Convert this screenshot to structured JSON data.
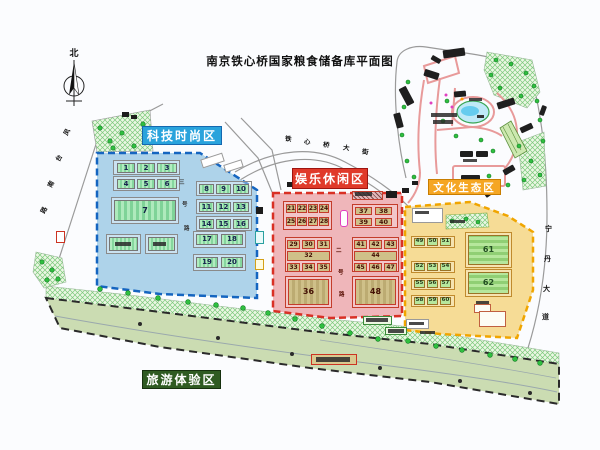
{
  "title": "南京铁心桥国家粮食储备库平面图",
  "compass_north": "北",
  "zones": {
    "tech": {
      "label": "科技时尚区",
      "label_bg": "#29a3dc",
      "label_border": "#1468b0",
      "fill": "#aed3ea",
      "border": "#1565c0"
    },
    "leisure": {
      "label": "娱乐休闲区",
      "label_bg": "#e03a2a",
      "label_border": "#9e1410",
      "fill": "#efb6ba",
      "border": "#d93025"
    },
    "culture": {
      "label": "文化生态区",
      "label_bg": "#f5a623",
      "label_border": "#c87d00",
      "fill": "#f6dc96",
      "border": "#f0a500"
    },
    "tourism": {
      "label": "旅游体验区",
      "label_bg": "#2f5b22",
      "label_border": "#16300e",
      "fill": "#cbdcb2",
      "border": "#2a2a2a"
    }
  },
  "road_labels": {
    "top_street": {
      "text": [
        "铁",
        "心",
        "桥",
        "大",
        "街"
      ],
      "pos": [
        [
          285,
          136
        ],
        [
          304,
          139
        ],
        [
          323,
          142
        ],
        [
          343,
          145
        ],
        [
          362,
          149
        ]
      ],
      "rot": 8,
      "fs": 6.5,
      "color": "#111"
    },
    "left_road": {
      "text": [
        "凤",
        "台",
        "南",
        "路"
      ],
      "pos": [
        [
          64,
          129
        ],
        [
          56,
          155
        ],
        [
          48,
          181
        ],
        [
          41,
          207
        ]
      ],
      "rot": -62,
      "fs": 6.5,
      "color": "#111"
    },
    "right_road": {
      "text": [
        "宁",
        "丹",
        "大",
        "道"
      ],
      "pos": [
        [
          545,
          226
        ],
        [
          544,
          256
        ],
        [
          543,
          286
        ],
        [
          542,
          314
        ]
      ],
      "rot": 0,
      "fs": 7,
      "color": "#111"
    },
    "tech_inner": {
      "text": [
        "三",
        "号",
        "路"
      ],
      "pos": [
        [
          179,
          181
        ],
        [
          182,
          203
        ],
        [
          184,
          227
        ]
      ],
      "rot": 0,
      "fs": 5.5,
      "color": "#333"
    },
    "leisure_inner": {
      "text": [
        "二",
        "号",
        "路"
      ],
      "pos": [
        [
          336,
          249
        ],
        [
          338,
          271
        ],
        [
          339,
          293
        ]
      ],
      "rot": 0,
      "fs": 5.5,
      "color": "#5a1005"
    }
  },
  "buildings": {
    "tech": [
      {
        "c": "fb",
        "x": 113,
        "y": 160,
        "w": 67,
        "h": 15
      },
      {
        "c": "fb",
        "x": 113,
        "y": 176,
        "w": 67,
        "h": 15
      },
      {
        "c": "fb",
        "x": 111,
        "y": 197,
        "w": 68,
        "h": 27
      },
      {
        "c": "fb",
        "x": 106,
        "y": 234,
        "w": 35,
        "h": 20
      },
      {
        "c": "fb",
        "x": 145,
        "y": 234,
        "w": 33,
        "h": 20
      },
      {
        "c": "fb",
        "x": 196,
        "y": 181,
        "w": 56,
        "h": 15
      },
      {
        "c": "fb",
        "x": 196,
        "y": 199,
        "w": 56,
        "h": 15
      },
      {
        "c": "fb",
        "x": 196,
        "y": 216,
        "w": 56,
        "h": 15
      },
      {
        "c": "fb",
        "x": 193,
        "y": 231,
        "w": 53,
        "h": 17
      },
      {
        "c": "fb",
        "x": 193,
        "y": 254,
        "w": 53,
        "h": 17
      },
      {
        "n": "1",
        "c": "g",
        "x": 117,
        "y": 163,
        "w": 18,
        "h": 10
      },
      {
        "n": "2",
        "c": "g",
        "x": 137,
        "y": 163,
        "w": 18,
        "h": 10
      },
      {
        "n": "3",
        "c": "g",
        "x": 157,
        "y": 163,
        "w": 20,
        "h": 10
      },
      {
        "n": "4",
        "c": "g",
        "x": 117,
        "y": 179,
        "w": 18,
        "h": 10
      },
      {
        "n": "5",
        "c": "g",
        "x": 137,
        "y": 179,
        "w": 18,
        "h": 10
      },
      {
        "n": "6",
        "c": "g",
        "x": 157,
        "y": 179,
        "w": 20,
        "h": 10
      },
      {
        "n": "7",
        "c": "G",
        "x": 114,
        "y": 200,
        "w": 62,
        "h": 21
      },
      {
        "c": "g",
        "x": 109,
        "y": 237,
        "w": 29,
        "h": 14
      },
      {
        "c": "g",
        "x": 148,
        "y": 237,
        "w": 27,
        "h": 14
      },
      {
        "n": "8",
        "c": "g",
        "x": 199,
        "y": 184,
        "w": 15,
        "h": 10
      },
      {
        "n": "9",
        "c": "g",
        "x": 216,
        "y": 184,
        "w": 15,
        "h": 10
      },
      {
        "n": "10",
        "c": "g",
        "x": 233,
        "y": 184,
        "w": 16,
        "h": 10
      },
      {
        "n": "11",
        "c": "g",
        "x": 199,
        "y": 202,
        "w": 15,
        "h": 10
      },
      {
        "n": "12",
        "c": "g",
        "x": 216,
        "y": 202,
        "w": 15,
        "h": 10
      },
      {
        "n": "13",
        "c": "g",
        "x": 233,
        "y": 202,
        "w": 16,
        "h": 10
      },
      {
        "n": "14",
        "c": "g",
        "x": 199,
        "y": 219,
        "w": 15,
        "h": 10
      },
      {
        "n": "15",
        "c": "g",
        "x": 216,
        "y": 219,
        "w": 15,
        "h": 10
      },
      {
        "n": "16",
        "c": "g",
        "x": 233,
        "y": 219,
        "w": 16,
        "h": 10
      },
      {
        "n": "17",
        "c": "g",
        "x": 196,
        "y": 234,
        "w": 22,
        "h": 11
      },
      {
        "n": "18",
        "c": "g",
        "x": 221,
        "y": 234,
        "w": 22,
        "h": 11
      },
      {
        "n": "19",
        "c": "g",
        "x": 196,
        "y": 257,
        "w": 22,
        "h": 11
      },
      {
        "n": "20",
        "c": "g",
        "x": 221,
        "y": 257,
        "w": 22,
        "h": 11
      }
    ],
    "leisure": [
      {
        "c": "fr",
        "x": 283,
        "y": 201,
        "w": 49,
        "h": 29
      },
      {
        "c": "fr",
        "x": 352,
        "y": 204,
        "w": 46,
        "h": 24
      },
      {
        "c": "fr",
        "x": 285,
        "y": 237,
        "w": 47,
        "h": 35
      },
      {
        "c": "fr",
        "x": 352,
        "y": 237,
        "w": 47,
        "h": 35
      },
      {
        "c": "fr",
        "x": 285,
        "y": 276,
        "w": 47,
        "h": 32
      },
      {
        "c": "fr",
        "x": 352,
        "y": 276,
        "w": 47,
        "h": 32
      },
      {
        "c": "h",
        "x": 352,
        "y": 191,
        "w": 31,
        "h": 9
      },
      {
        "c": "d",
        "x": 386,
        "y": 191,
        "w": 11,
        "h": 7
      },
      {
        "n": "21",
        "c": "t",
        "x": 286,
        "y": 204,
        "w": 10,
        "h": 9
      },
      {
        "n": "22",
        "c": "t",
        "x": 297,
        "y": 204,
        "w": 10,
        "h": 9
      },
      {
        "n": "23",
        "c": "t",
        "x": 308,
        "y": 204,
        "w": 10,
        "h": 9
      },
      {
        "n": "24",
        "c": "t",
        "x": 319,
        "y": 204,
        "w": 10,
        "h": 9
      },
      {
        "n": "25",
        "c": "t",
        "x": 286,
        "y": 217,
        "w": 10,
        "h": 9
      },
      {
        "n": "26",
        "c": "t",
        "x": 297,
        "y": 217,
        "w": 10,
        "h": 9
      },
      {
        "n": "27",
        "c": "t",
        "x": 308,
        "y": 217,
        "w": 10,
        "h": 9
      },
      {
        "n": "28",
        "c": "t",
        "x": 319,
        "y": 217,
        "w": 10,
        "h": 9
      },
      {
        "n": "37",
        "c": "tw",
        "x": 355,
        "y": 207,
        "w": 17,
        "h": 8
      },
      {
        "n": "38",
        "c": "tw",
        "x": 375,
        "y": 207,
        "w": 17,
        "h": 8
      },
      {
        "n": "39",
        "c": "tw",
        "x": 355,
        "y": 218,
        "w": 17,
        "h": 8
      },
      {
        "n": "40",
        "c": "tw",
        "x": 375,
        "y": 218,
        "w": 17,
        "h": 8
      },
      {
        "n": "29",
        "c": "t",
        "x": 287,
        "y": 240,
        "w": 13,
        "h": 9
      },
      {
        "n": "30",
        "c": "t",
        "x": 302,
        "y": 240,
        "w": 13,
        "h": 9
      },
      {
        "n": "31",
        "c": "t",
        "x": 317,
        "y": 240,
        "w": 13,
        "h": 9
      },
      {
        "n": "32",
        "c": "t",
        "x": 287,
        "y": 251,
        "w": 43,
        "h": 10
      },
      {
        "n": "33",
        "c": "t",
        "x": 287,
        "y": 263,
        "w": 13,
        "h": 9
      },
      {
        "n": "34",
        "c": "t",
        "x": 302,
        "y": 263,
        "w": 13,
        "h": 9
      },
      {
        "n": "35",
        "c": "t",
        "x": 317,
        "y": 263,
        "w": 13,
        "h": 9
      },
      {
        "n": "41",
        "c": "t",
        "x": 354,
        "y": 240,
        "w": 13,
        "h": 9
      },
      {
        "n": "42",
        "c": "t",
        "x": 369,
        "y": 240,
        "w": 13,
        "h": 9
      },
      {
        "n": "43",
        "c": "t",
        "x": 384,
        "y": 240,
        "w": 13,
        "h": 9
      },
      {
        "n": "44",
        "c": "t",
        "x": 354,
        "y": 251,
        "w": 43,
        "h": 10
      },
      {
        "n": "45",
        "c": "t",
        "x": 354,
        "y": 263,
        "w": 13,
        "h": 9
      },
      {
        "n": "46",
        "c": "t",
        "x": 369,
        "y": 263,
        "w": 13,
        "h": 9
      },
      {
        "n": "47",
        "c": "t",
        "x": 384,
        "y": 263,
        "w": 13,
        "h": 9
      },
      {
        "n": "36",
        "c": "T",
        "x": 288,
        "y": 279,
        "w": 41,
        "h": 26
      },
      {
        "n": "48",
        "c": "T",
        "x": 355,
        "y": 279,
        "w": 41,
        "h": 26
      }
    ],
    "culture": [
      {
        "c": "fy",
        "x": 411,
        "y": 236,
        "w": 44,
        "h": 12
      },
      {
        "c": "fy",
        "x": 411,
        "y": 261,
        "w": 44,
        "h": 12
      },
      {
        "c": "fy",
        "x": 411,
        "y": 278,
        "w": 44,
        "h": 12
      },
      {
        "c": "fy",
        "x": 411,
        "y": 295,
        "w": 44,
        "h": 12
      },
      {
        "c": "fy",
        "x": 465,
        "y": 232,
        "w": 47,
        "h": 36
      },
      {
        "c": "fy",
        "x": 465,
        "y": 269,
        "w": 47,
        "h": 28
      },
      {
        "n": "49",
        "c": "cg",
        "x": 414,
        "y": 238,
        "w": 11,
        "h": 8
      },
      {
        "n": "50",
        "c": "cg",
        "x": 427,
        "y": 238,
        "w": 11,
        "h": 8
      },
      {
        "n": "51",
        "c": "cg",
        "x": 440,
        "y": 238,
        "w": 11,
        "h": 8
      },
      {
        "n": "52",
        "c": "cg",
        "x": 414,
        "y": 263,
        "w": 11,
        "h": 8
      },
      {
        "n": "53",
        "c": "cg",
        "x": 427,
        "y": 263,
        "w": 11,
        "h": 8
      },
      {
        "n": "54",
        "c": "cg",
        "x": 440,
        "y": 263,
        "w": 11,
        "h": 8
      },
      {
        "n": "55",
        "c": "cg",
        "x": 414,
        "y": 280,
        "w": 11,
        "h": 8
      },
      {
        "n": "56",
        "c": "cg",
        "x": 427,
        "y": 280,
        "w": 11,
        "h": 8
      },
      {
        "n": "57",
        "c": "cg",
        "x": 440,
        "y": 280,
        "w": 11,
        "h": 8
      },
      {
        "n": "58",
        "c": "cg",
        "x": 414,
        "y": 297,
        "w": 11,
        "h": 8
      },
      {
        "n": "59",
        "c": "cg",
        "x": 427,
        "y": 297,
        "w": 11,
        "h": 8
      },
      {
        "n": "60",
        "c": "cg",
        "x": 440,
        "y": 297,
        "w": 11,
        "h": 8
      },
      {
        "n": "61",
        "c": "CG",
        "x": 468,
        "y": 235,
        "w": 41,
        "h": 30
      },
      {
        "n": "62",
        "c": "CG",
        "x": 468,
        "y": 272,
        "w": 41,
        "h": 22
      }
    ]
  },
  "extras": [
    {
      "c": "wb",
      "x": 201,
      "y": 156,
      "w": 23,
      "h": 9,
      "r": -18
    },
    {
      "c": "wb",
      "x": 224,
      "y": 162,
      "w": 19,
      "h": 8,
      "r": -18
    },
    {
      "c": "wb",
      "x": 412,
      "y": 208,
      "w": 31,
      "h": 15
    },
    {
      "c": "wbr",
      "x": 474,
      "y": 304,
      "w": 17,
      "h": 9
    },
    {
      "c": "wbr",
      "x": 479,
      "y": 311,
      "w": 27,
      "h": 16
    },
    {
      "c": "wb",
      "x": 406,
      "y": 319,
      "w": 23,
      "h": 10
    },
    {
      "c": "gate",
      "x": 56,
      "y": 231,
      "w": 9,
      "h": 12
    },
    {
      "c": "mag",
      "x": 340,
      "y": 210,
      "w": 8,
      "h": 17
    },
    {
      "c": "teal",
      "x": 255,
      "y": 231,
      "w": 9,
      "h": 13
    },
    {
      "c": "ych",
      "x": 255,
      "y": 259,
      "w": 9,
      "h": 11
    },
    {
      "c": "gch",
      "x": 363,
      "y": 316,
      "w": 29,
      "h": 9
    },
    {
      "c": "gch",
      "x": 385,
      "y": 327,
      "w": 22,
      "h": 8
    },
    {
      "c": "bch",
      "x": 311,
      "y": 354,
      "w": 46,
      "h": 11
    }
  ],
  "marks": {
    "smudges": [
      [
        115,
        242,
        16,
        4
      ],
      [
        153,
        242,
        13,
        4
      ],
      [
        355,
        192,
        17,
        4
      ],
      [
        415,
        211,
        14,
        3
      ],
      [
        450,
        220,
        15,
        3
      ],
      [
        476,
        301,
        13,
        3
      ],
      [
        409,
        322,
        15,
        3
      ],
      [
        420,
        331,
        15,
        3
      ],
      [
        431,
        113,
        26,
        4
      ],
      [
        433,
        120,
        20,
        4
      ],
      [
        469,
        98,
        13,
        3
      ],
      [
        463,
        159,
        14,
        3
      ],
      [
        366,
        318,
        22,
        4
      ],
      [
        388,
        329,
        16,
        4
      ],
      [
        316,
        357,
        34,
        5
      ]
    ],
    "dark_bits": [
      [
        287,
        182,
        6,
        5
      ],
      [
        402,
        188,
        7,
        5
      ],
      [
        412,
        181,
        6,
        4
      ],
      [
        122,
        112,
        7,
        5
      ],
      [
        131,
        115,
        6,
        4
      ],
      [
        256,
        207,
        7,
        7
      ]
    ],
    "site_buildings": [
      [
        443,
        49,
        22,
        8,
        -8
      ],
      [
        424,
        71,
        15,
        7,
        18
      ],
      [
        397,
        92,
        19,
        8,
        62
      ],
      [
        391,
        117,
        15,
        7,
        75
      ],
      [
        454,
        91,
        12,
        6,
        -5
      ],
      [
        497,
        100,
        18,
        7,
        -18
      ],
      [
        520,
        125,
        13,
        6,
        -25
      ],
      [
        460,
        151,
        13,
        6,
        0
      ],
      [
        476,
        151,
        12,
        6,
        0
      ],
      [
        461,
        175,
        19,
        7,
        0
      ],
      [
        503,
        167,
        12,
        6,
        -30
      ],
      [
        431,
        57,
        10,
        5,
        30
      ],
      [
        484,
        189,
        12,
        6,
        -35
      ],
      [
        538,
        108,
        10,
        5,
        -70
      ]
    ]
  }
}
